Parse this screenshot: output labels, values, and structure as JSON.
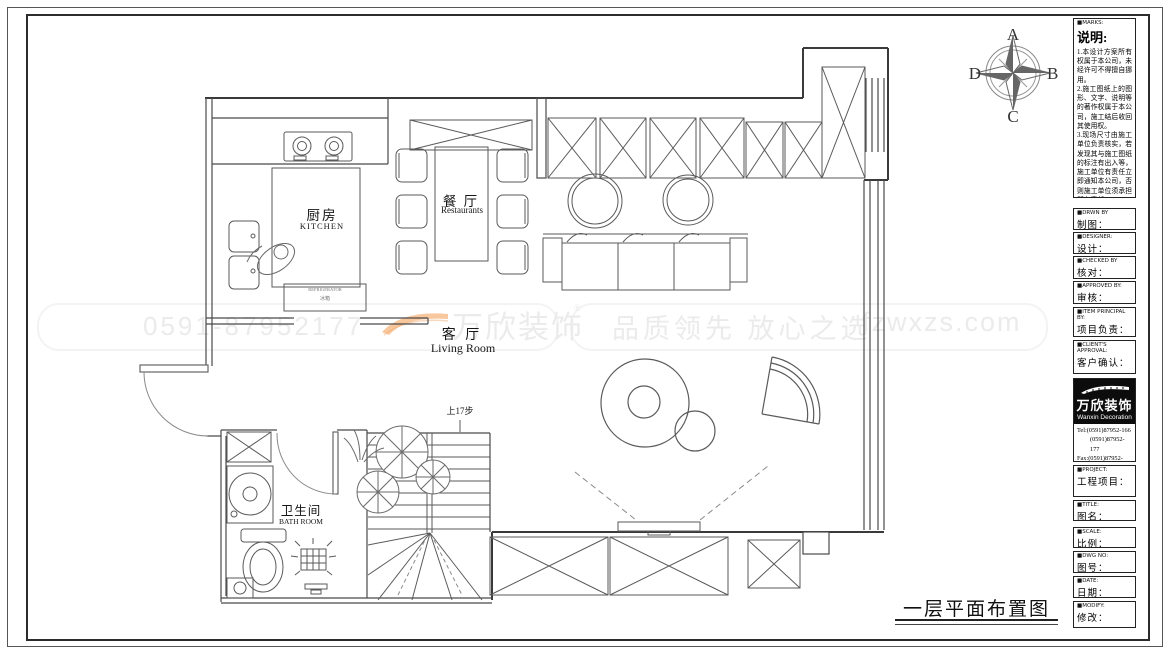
{
  "plan": {
    "title": "一层平面布置图",
    "stairs_note": "上17步",
    "rooms": {
      "kitchen_zh": "厨房",
      "kitchen_en": "KITCHEN",
      "dining_zh": "餐 厅",
      "dining_en": "Restaurants",
      "living_zh": "客 厅",
      "living_en": "Living Room",
      "bath_zh": "卫生间",
      "bath_en": "BATH ROOM"
    },
    "fridge_line1": "REFRIGERATOR",
    "fridge_line2": "冰箱"
  },
  "compass": {
    "top": "A",
    "right": "B",
    "bottom": "C",
    "left": "D"
  },
  "watermark": {
    "phone": "0591-87952177",
    "brand": "万欣装饰",
    "reg": "®",
    "slogan": "品质领先 放心之选",
    "site": "fzwxzs.com"
  },
  "titleblock": {
    "marks_header": "■MARKS:",
    "notes_title": "说明:",
    "note1": "1.本设计方案所有权属于本公司，未经许可不得擅自挪用。",
    "note2": "2.施工图纸上的图形、文字、说明等的著作权属于本公司，施工结后收回其使用权。",
    "note3": "3.现场尺寸由施工单位负责核实，若发现其与施工图纸的标注有出入等，施工单位有责任立即通知本公司，否则施工单位须承担所有责任。",
    "note4": "4.本设计方案是依客户要求设计，经客户签字即视为同意认可，不得随意更改。",
    "fields": [
      {
        "en": "■DRWN BY",
        "zh": "制图："
      },
      {
        "en": "■DESIGNER:",
        "zh": "设计："
      },
      {
        "en": "■CHECKED BY",
        "zh": "核对："
      },
      {
        "en": "■APPROVED BY:",
        "zh": "审核："
      },
      {
        "en": "■ITEM PRINCIPAL BY:",
        "zh": "项目负责："
      },
      {
        "en": "■CLIENT'S APPROVAL:",
        "zh": "客户确认："
      }
    ],
    "logo_zh": "万欣装饰",
    "logo_en": "Wanxin Decoration",
    "tel1": "Tel:(0591)87952-166",
    "tel2": "(0591)87952-177",
    "fax": "Fax:(0591)87952-199",
    "web": "Web:WWW.fzwxzs.com",
    "fields2": [
      {
        "en": "■PROJECT:",
        "zh": "工程项目："
      },
      {
        "en": "■TITLE:",
        "zh": "图名："
      },
      {
        "en": "■SCALE:",
        "zh": "比例："
      },
      {
        "en": "■DWG NO:",
        "zh": "图号："
      },
      {
        "en": "■DATE:",
        "zh": "日期："
      },
      {
        "en": "■MODIFY:",
        "zh": "修改："
      }
    ]
  }
}
